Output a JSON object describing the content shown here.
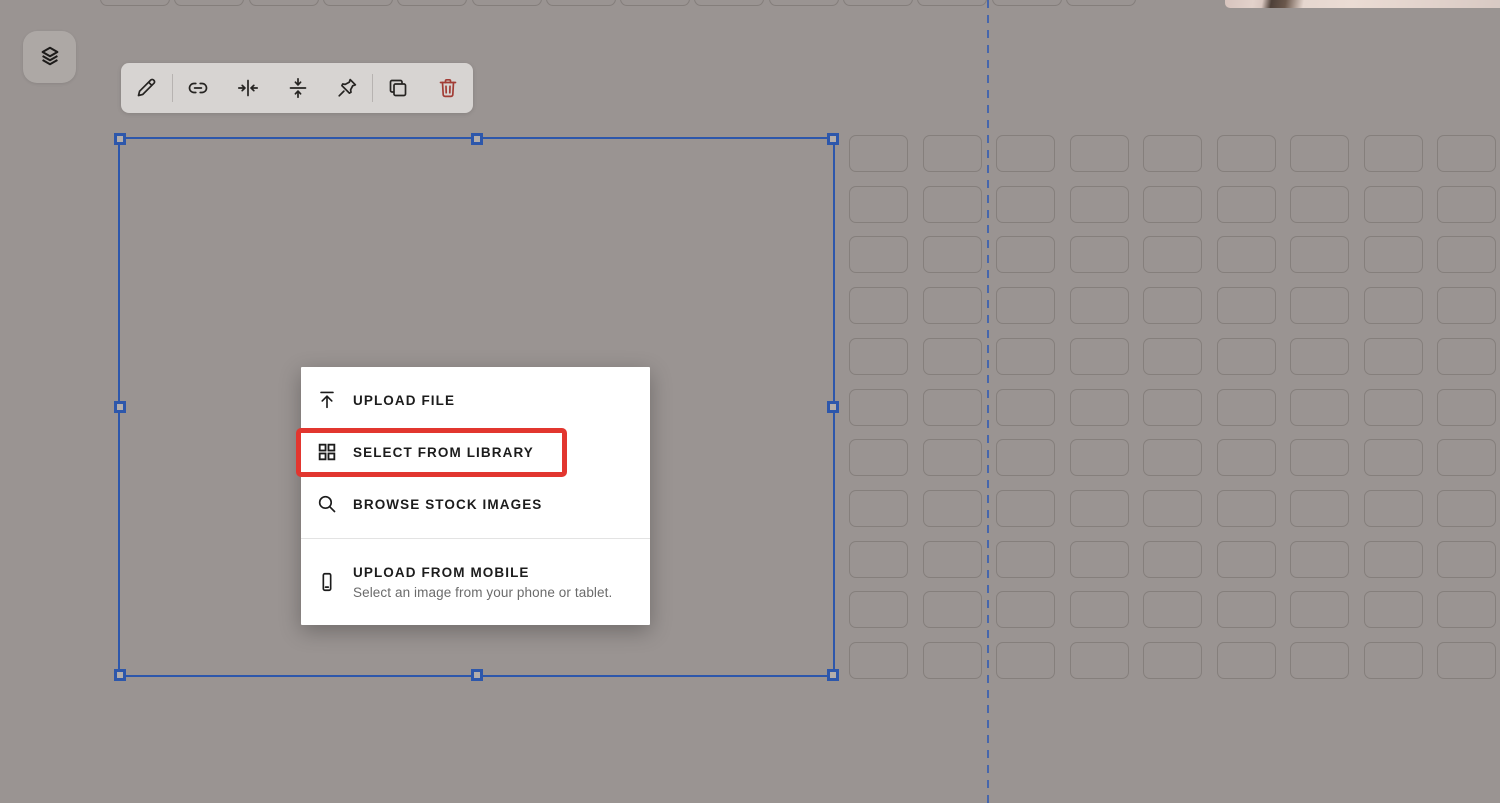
{
  "canvas": {
    "background": "#9a9492"
  },
  "guide": {
    "x": 988,
    "color": "#3f62ae",
    "style": "dashed-vertical"
  },
  "layers_button": {
    "name": "layers",
    "icon": "layers-icon"
  },
  "toolbar": {
    "items": [
      {
        "name": "edit",
        "icon": "pencil-icon"
      },
      {
        "name": "link",
        "icon": "link-icon"
      },
      {
        "name": "align-horizontal-center",
        "icon": "align-horizontal-center-icon"
      },
      {
        "name": "align-vertical-center",
        "icon": "align-vertical-center-icon"
      },
      {
        "name": "pin",
        "icon": "pin-icon"
      },
      {
        "name": "duplicate",
        "icon": "duplicate-icon"
      },
      {
        "name": "delete",
        "icon": "trash-icon",
        "color": "#a23c35"
      }
    ]
  },
  "selection": {
    "accent": "#2d57ab",
    "handle_count": 8
  },
  "menu": {
    "items": [
      {
        "icon": "upload-icon",
        "label": "UPLOAD FILE"
      },
      {
        "icon": "library-grid-icon",
        "label": "SELECT FROM LIBRARY",
        "highlighted": true
      },
      {
        "icon": "search-icon",
        "label": "BROWSE STOCK IMAGES"
      },
      {
        "icon": "mobile-phone-icon",
        "label": "UPLOAD FROM MOBILE",
        "sublabel": "Select an image from your phone or tablet."
      }
    ],
    "highlight_color": "#e2362f"
  },
  "spacer_grid": {
    "columns": 9,
    "rows": 11,
    "col_pitch": 73.5,
    "row_pitch": 50.7
  },
  "top_strip": {
    "cells": 14,
    "pitch": 74.3
  }
}
